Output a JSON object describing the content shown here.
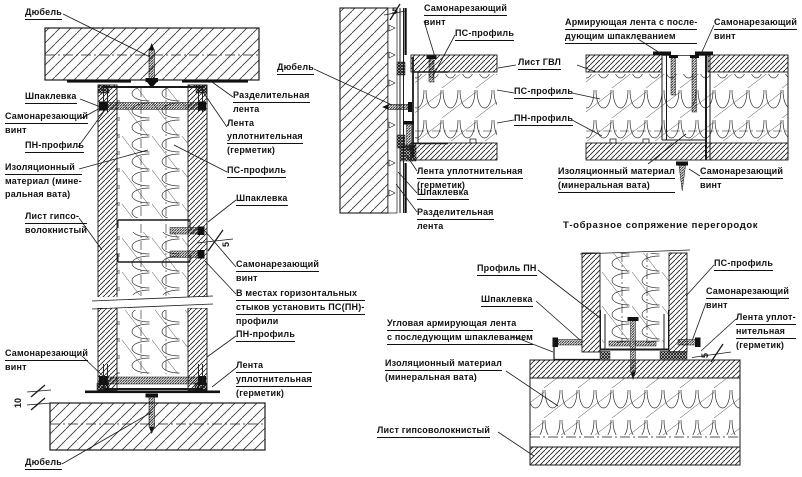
{
  "title": "Т-образное сопряжение перегородок",
  "dims": {
    "five": "5",
    "ten": "10"
  },
  "labels": {
    "left_top_dowel": [
      "Дюбель"
    ],
    "left_putty": [
      "Шпаклевка"
    ],
    "left_screw_top": [
      "Самонарезающий",
      "винт"
    ],
    "left_pn_profile": [
      "ПН-профиль"
    ],
    "left_insulation": [
      "Изоляционный",
      "материал (мине-",
      "ральная вата)"
    ],
    "left_gvl": [
      "Лист гипсо-",
      "волокнистый"
    ],
    "left_screw_bottom": [
      "Самонарезающий",
      "винт"
    ],
    "left_bottom_dowel": [
      "Дюбель"
    ],
    "left_sep_tape": [
      "Разделительная",
      "лента"
    ],
    "left_seal_tape_top": [
      "Лента",
      "уплотнительная",
      "(герметик)"
    ],
    "left_ps_profile": [
      "ПС-профиль"
    ],
    "left_putty_right": [
      "Шпаклевка"
    ],
    "left_screw_right": [
      "Самонарезающий",
      "винт"
    ],
    "left_note": [
      "В местах горизонтальных",
      "стыков установить ПС(ПН)-",
      "профили"
    ],
    "left_pn_profile_right": [
      "ПН-профиль"
    ],
    "left_seal_tape_bottom": [
      "Лента",
      "уплотнительная",
      "(герметик)"
    ],
    "mid_screw_top": [
      "Самонарезающий",
      "винт"
    ],
    "mid_ps_profile": [
      "ПС-профиль"
    ],
    "mid_dowel": [
      "Дюбель"
    ],
    "mid_reinf_tape": [
      "Армирующая лента с после-",
      "дующим шпаклеванием"
    ],
    "mid_screw_right": [
      "Самонарезающий",
      "винт"
    ],
    "mid_gvl": [
      "Лист ГВЛ"
    ],
    "mid_ps2": [
      "ПС-профиль"
    ],
    "mid_pn": [
      "ПН-профиль"
    ],
    "mid_seal": [
      "Лента уплотнительная",
      "(герметик)"
    ],
    "mid_putty": [
      "Шпаклевка"
    ],
    "mid_sep": [
      "Разделительная",
      "лента"
    ],
    "mid_insulation": [
      "Изоляционный материал",
      "(минеральная вата)"
    ],
    "mid_screw_bottom": [
      "Самонарезающий",
      "винт"
    ],
    "br_pn": [
      "Профиль ПН"
    ],
    "br_putty": [
      "Шпаклевка"
    ],
    "br_corner_tape": [
      "Угловая армирующая лента",
      "с последующим шпаклеванием"
    ],
    "br_insulation": [
      "Изоляционный материал",
      "(минеральная вата)"
    ],
    "br_gvl": [
      "Лист гипсоволокнистый"
    ],
    "br_ps": [
      "ПС-профиль"
    ],
    "br_screw": [
      "Самонарезающий",
      "винт"
    ],
    "br_seal": [
      "Лента уплот-",
      "нительная",
      "(герметик)"
    ]
  }
}
